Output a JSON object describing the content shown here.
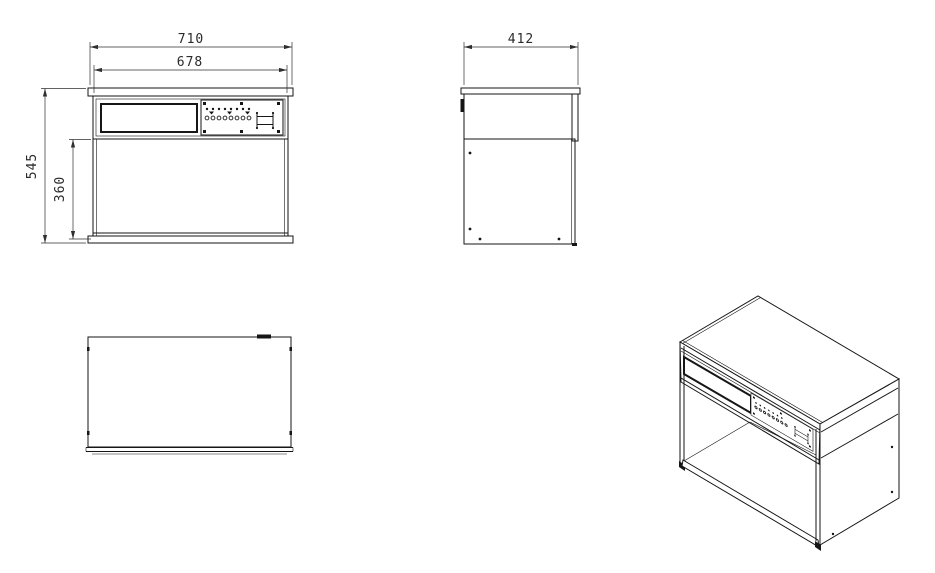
{
  "style": {
    "background": "#ffffff",
    "object_line_color": "#161616",
    "dimension_line_color": "#2f2f2f",
    "dimension_text_color": "#2b2b2b"
  },
  "dimensions": {
    "front_outer_width_mm": "710",
    "front_lamp_housing_width_mm": "678",
    "front_outer_height_mm": "545",
    "front_opening_height_mm": "360",
    "side_depth_mm": "412"
  }
}
